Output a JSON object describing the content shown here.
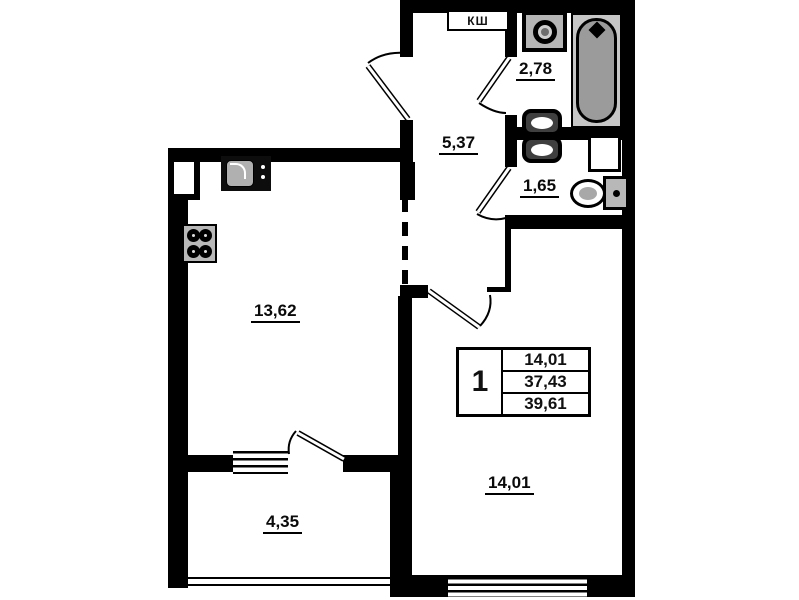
{
  "plan": {
    "type": "apartment-floor-plan",
    "shaft_label": "КШ",
    "rooms": {
      "bathroom": {
        "area": "2,78"
      },
      "hallway": {
        "area": "5,37"
      },
      "toilet": {
        "area": "1,65"
      },
      "kitchen_living": {
        "area": "13,62"
      },
      "balcony": {
        "area": "4,35"
      },
      "bedroom": {
        "area": "14,01"
      }
    },
    "info_table": {
      "rooms_count": "1",
      "living_area": "14,01",
      "apartment_area": "37,43",
      "total_area": "39,61"
    },
    "fixtures": [
      "bathtub",
      "washing-machine",
      "double-sink",
      "toilet",
      "kitchen-sink",
      "stove"
    ],
    "colors": {
      "wall": "#000000",
      "background": "#ffffff",
      "fixture_dark_gray": "#9b9b9b",
      "fixture_light_gray": "#c6c6c6"
    }
  }
}
